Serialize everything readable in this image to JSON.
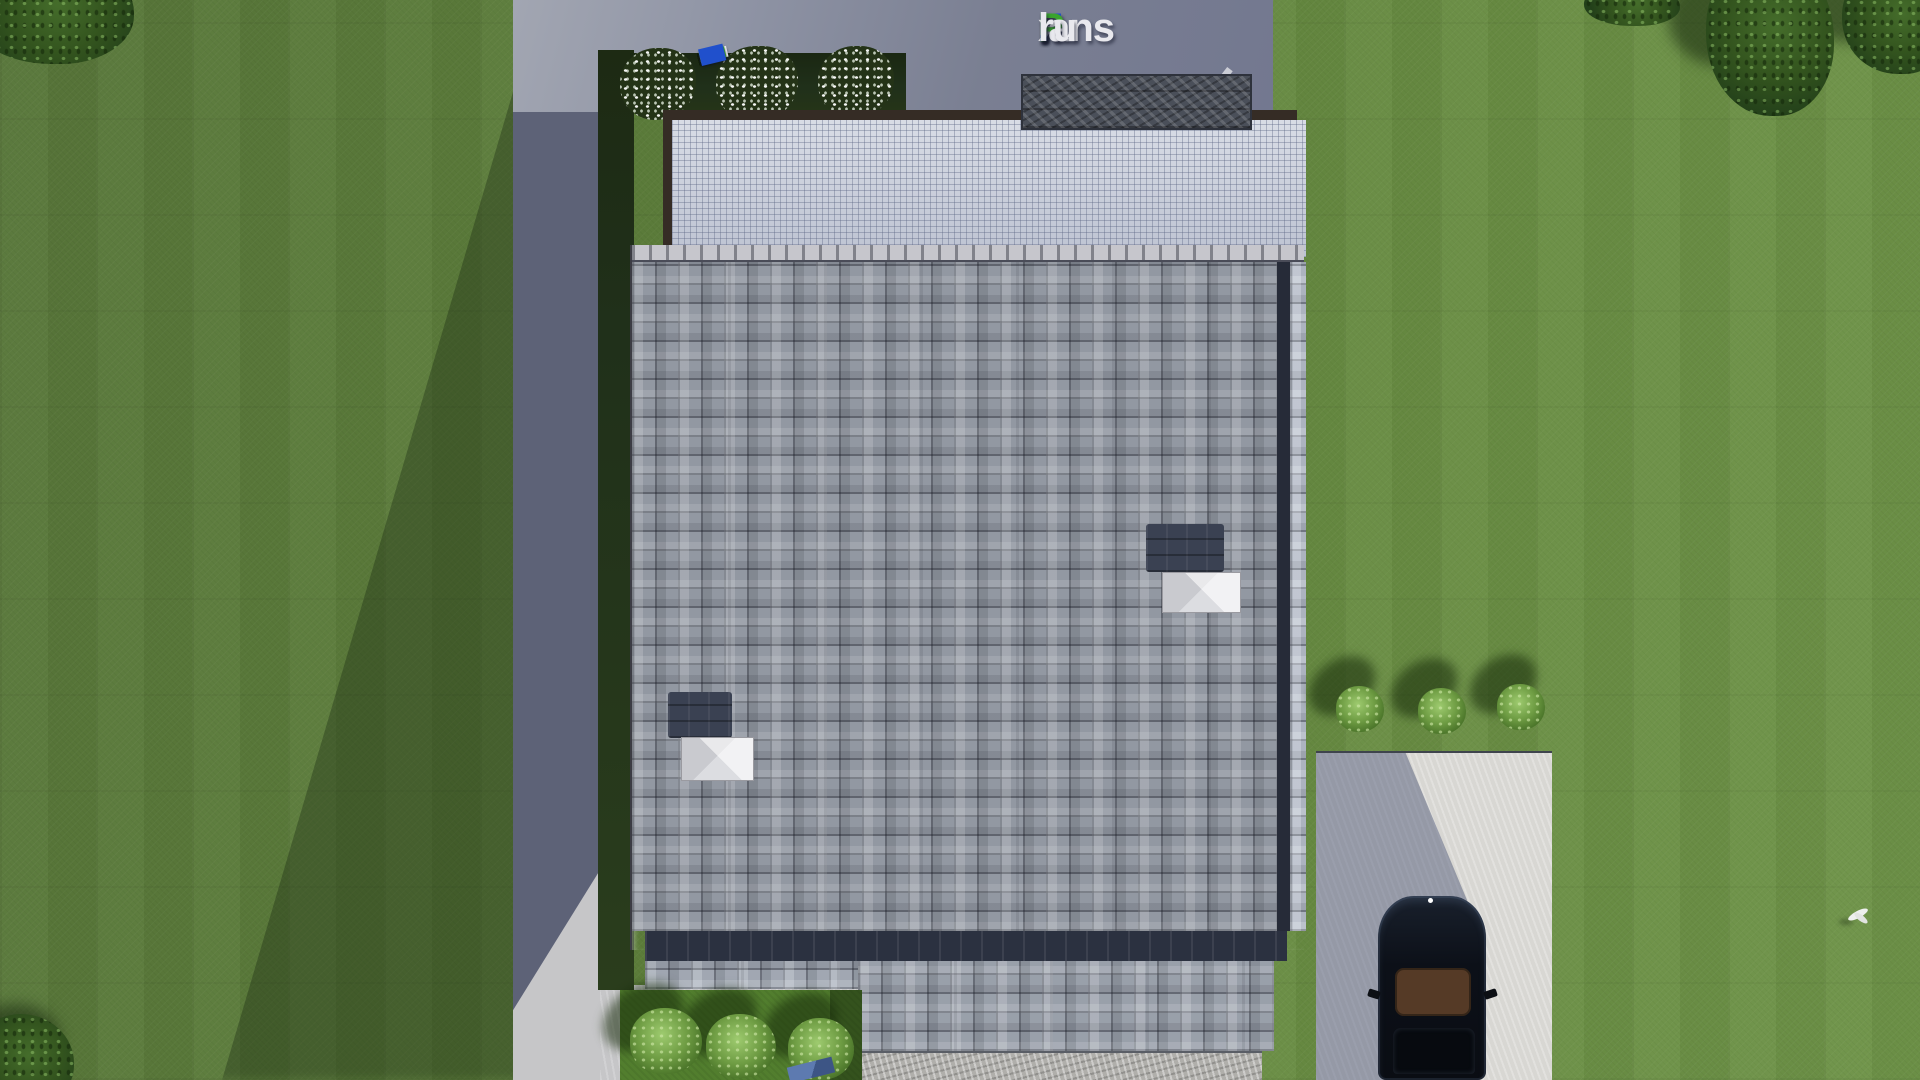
{
  "watermark": {
    "text": "FixPlans.ru",
    "parts": [
      {
        "text": "F",
        "color": "#2050cc"
      },
      {
        "text": "i",
        "color": "#3aa52e"
      },
      {
        "text": "x",
        "color": "#e9e9ee"
      },
      {
        "text": "P",
        "color": "#3aa52e"
      },
      {
        "text": "lans",
        "color": "#e9e9ee"
      },
      {
        "text": ".",
        "color": "#2050cc"
      },
      {
        "text": "ru",
        "color": "#e9e9ee"
      }
    ]
  },
  "fence": {
    "segments": [
      {
        "color": "#e9e9ee",
        "w": 14,
        "h": 10
      },
      {
        "color": "#e9e9ee",
        "w": 10,
        "h": 10
      },
      {
        "color": "#2050cc",
        "w": 12,
        "h": 10
      },
      {
        "color": "#e9e9ee",
        "w": 26,
        "h": 11
      },
      {
        "color": "#e9e9ee",
        "w": 12,
        "h": 10
      },
      {
        "color": "#e9e9ee",
        "w": 28,
        "h": 11
      },
      {
        "color": "#e9e9ee",
        "w": 10,
        "h": 10
      },
      {
        "color": "#3fae2e",
        "w": 26,
        "h": 11
      },
      {
        "color": "#e9e9ee",
        "w": 24,
        "h": 11
      },
      {
        "color": "#e9e9ee",
        "w": 10,
        "h": 10
      },
      {
        "color": "#3fae2e",
        "w": 13,
        "h": 11
      },
      {
        "color": "#2050cc",
        "w": 25,
        "h": 17
      }
    ]
  },
  "scene": {
    "type": "aerial 3d render of house plan",
    "skylight_count": 2,
    "flower_bush_count": 3,
    "green_bush_bottom_count": 3,
    "green_bush_right_count": 3,
    "tree_count": 5,
    "car_count": 1
  },
  "palette": {
    "grass-left": "#58763a",
    "grass-right": "#6a8e44",
    "tree-dark": "#23401a",
    "paved-shadow": "#7a7f92",
    "path-shadow": "#5d6277",
    "concrete-light": "#c6c6c8",
    "stone-walk": "#b0afab",
    "driveway": "#d8d7d3",
    "roof-base": "#9298a2",
    "ridge": "#c6c6cc",
    "roof-gutter": "#2b3140",
    "pergola-grid": "#ccd1dd",
    "pergola-frame": "#352c25",
    "stone-wall": "#4a4f59",
    "bed-dark": "#20301a",
    "bed-bright": "#527e2e",
    "bush-green": "#4a7429",
    "car-body": "#0a0d13",
    "car-roof": "#553a26",
    "doormat": "#3d5585"
  }
}
